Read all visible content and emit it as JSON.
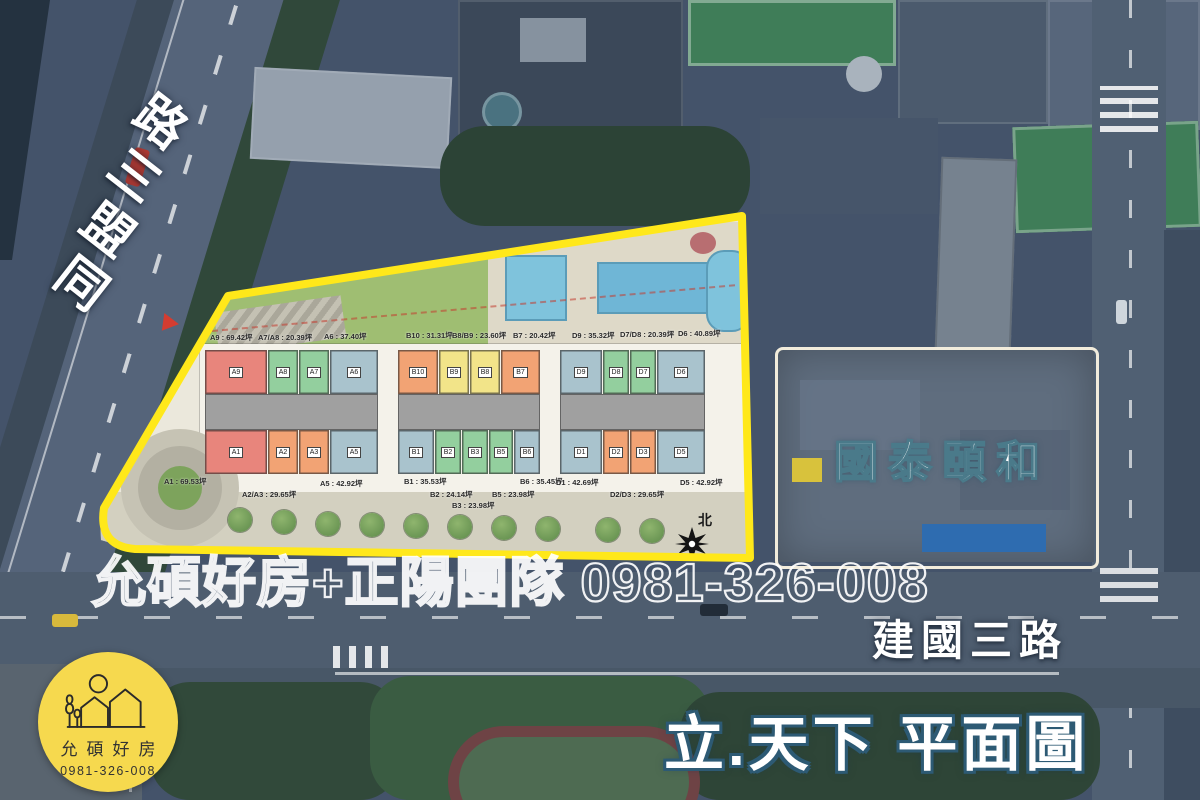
{
  "colors": {
    "aerial-base": "#44536a",
    "boundary-yellow": "#ffe81a",
    "unit-red": "#e8857c",
    "unit-green": "#93cf9e",
    "unit-blue": "#a9c3cd",
    "unit-orange": "#f2a374",
    "unit-yellow": "#f2e489",
    "logo-yellow": "#f6d94e"
  },
  "left_road": "同盟三路",
  "bottom_road": "建國三路",
  "title": "立.天下 平面圖",
  "adjacent_site": "國泰頤和",
  "watermark": "允碩好房+正陽團隊 0981-326-008",
  "logo": {
    "name": "允碩好房",
    "phone": "0981-326-008"
  },
  "compass_label": "北",
  "plan": {
    "top_area_labels": [
      {
        "text": "A9 : 69.42坪",
        "x": 210,
        "y": 332
      },
      {
        "text": "A7/A8 : 20.39坪",
        "x": 258,
        "y": 332
      },
      {
        "text": "A6 : 37.40坪",
        "x": 324,
        "y": 331
      },
      {
        "text": "B10 : 31.31坪",
        "x": 406,
        "y": 330
      },
      {
        "text": "B8/B9 : 23.60坪",
        "x": 452,
        "y": 330
      },
      {
        "text": "B7 : 20.42坪",
        "x": 513,
        "y": 330
      },
      {
        "text": "D9 : 35.32坪",
        "x": 572,
        "y": 330
      },
      {
        "text": "D7/D8 : 20.39坪",
        "x": 620,
        "y": 329
      },
      {
        "text": "D6 : 40.89坪",
        "x": 678,
        "y": 328
      }
    ],
    "bottom_area_labels": [
      {
        "text": "A1 : 69.53坪",
        "x": 164,
        "y": 476
      },
      {
        "text": "A2/A3 : 29.65坪",
        "x": 242,
        "y": 489
      },
      {
        "text": "A5 : 42.92坪",
        "x": 320,
        "y": 478
      },
      {
        "text": "B1 : 35.53坪",
        "x": 404,
        "y": 476
      },
      {
        "text": "B2 : 24.14坪",
        "x": 430,
        "y": 489
      },
      {
        "text": "B3 : 23.98坪",
        "x": 452,
        "y": 500
      },
      {
        "text": "B5 : 23.98坪",
        "x": 492,
        "y": 489
      },
      {
        "text": "B6 : 35.45坪",
        "x": 520,
        "y": 476
      },
      {
        "text": "D1 : 42.69坪",
        "x": 556,
        "y": 477
      },
      {
        "text": "D2/D3 : 29.65坪",
        "x": 610,
        "y": 489
      },
      {
        "text": "D5 : 42.92坪",
        "x": 680,
        "y": 477
      }
    ],
    "units": [
      {
        "tag": "A9",
        "x": 205,
        "y": 350,
        "w": 62,
        "h": 44,
        "color": "red"
      },
      {
        "tag": "A8",
        "x": 268,
        "y": 350,
        "w": 30,
        "h": 44,
        "color": "green"
      },
      {
        "tag": "A7",
        "x": 299,
        "y": 350,
        "w": 30,
        "h": 44,
        "color": "green"
      },
      {
        "tag": "A6",
        "x": 330,
        "y": 350,
        "w": 48,
        "h": 44,
        "color": "blue"
      },
      {
        "tag": "A1",
        "x": 205,
        "y": 430,
        "w": 62,
        "h": 44,
        "color": "red"
      },
      {
        "tag": "A2",
        "x": 268,
        "y": 430,
        "w": 30,
        "h": 44,
        "color": "orange"
      },
      {
        "tag": "A3",
        "x": 299,
        "y": 430,
        "w": 30,
        "h": 44,
        "color": "orange"
      },
      {
        "tag": "A5",
        "x": 330,
        "y": 430,
        "w": 48,
        "h": 44,
        "color": "blue"
      },
      {
        "tag": "B10",
        "x": 398,
        "y": 350,
        "w": 40,
        "h": 44,
        "color": "orange"
      },
      {
        "tag": "B9",
        "x": 439,
        "y": 350,
        "w": 30,
        "h": 44,
        "color": "yellow"
      },
      {
        "tag": "B8",
        "x": 470,
        "y": 350,
        "w": 30,
        "h": 44,
        "color": "yellow"
      },
      {
        "tag": "B7",
        "x": 501,
        "y": 350,
        "w": 39,
        "h": 44,
        "color": "orange"
      },
      {
        "tag": "B1",
        "x": 398,
        "y": 430,
        "w": 36,
        "h": 44,
        "color": "blue"
      },
      {
        "tag": "B2",
        "x": 435,
        "y": 430,
        "w": 26,
        "h": 44,
        "color": "green"
      },
      {
        "tag": "B3",
        "x": 462,
        "y": 430,
        "w": 26,
        "h": 44,
        "color": "green"
      },
      {
        "tag": "B5",
        "x": 489,
        "y": 430,
        "w": 24,
        "h": 44,
        "color": "green"
      },
      {
        "tag": "B6",
        "x": 514,
        "y": 430,
        "w": 26,
        "h": 44,
        "color": "blue"
      },
      {
        "tag": "D9",
        "x": 560,
        "y": 350,
        "w": 42,
        "h": 44,
        "color": "blue"
      },
      {
        "tag": "D8",
        "x": 603,
        "y": 350,
        "w": 26,
        "h": 44,
        "color": "green"
      },
      {
        "tag": "D7",
        "x": 630,
        "y": 350,
        "w": 26,
        "h": 44,
        "color": "green"
      },
      {
        "tag": "D6",
        "x": 657,
        "y": 350,
        "w": 48,
        "h": 44,
        "color": "blue"
      },
      {
        "tag": "D1",
        "x": 560,
        "y": 430,
        "w": 42,
        "h": 44,
        "color": "blue"
      },
      {
        "tag": "D2",
        "x": 603,
        "y": 430,
        "w": 26,
        "h": 44,
        "color": "orange"
      },
      {
        "tag": "D3",
        "x": 630,
        "y": 430,
        "w": 26,
        "h": 44,
        "color": "orange"
      },
      {
        "tag": "D5",
        "x": 657,
        "y": 430,
        "w": 48,
        "h": 44,
        "color": "blue"
      }
    ]
  }
}
